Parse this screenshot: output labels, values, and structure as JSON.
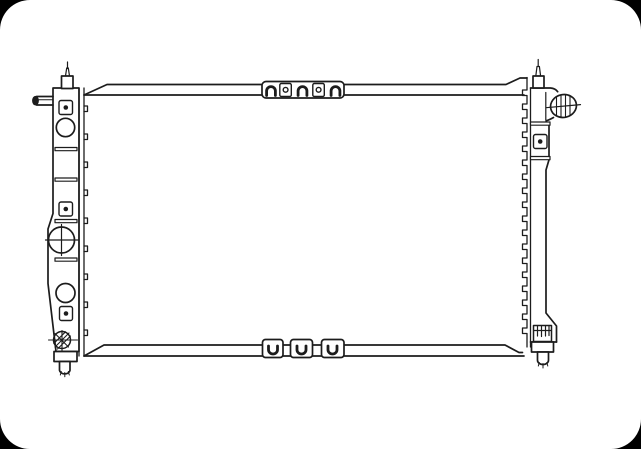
{
  "colors": {
    "line": "#1c1c1c",
    "paper": "#ffffff",
    "corner_mask": "#000000"
  },
  "drawing": {
    "subject": "radiator-technical-line-drawing",
    "visible_text": [],
    "parts": [
      {
        "name": "core-top-rail"
      },
      {
        "name": "core-bottom-rail"
      },
      {
        "name": "top-mount-bracket"
      },
      {
        "name": "bottom-mount-tabs"
      },
      {
        "name": "left-tank"
      },
      {
        "name": "filler-neck"
      },
      {
        "name": "left-inlet-pipe"
      },
      {
        "name": "mounting-hole-square"
      },
      {
        "name": "mounting-boss-circle"
      },
      {
        "name": "crosshair-boss"
      },
      {
        "name": "drain-plug"
      },
      {
        "name": "left-bottom-stub"
      },
      {
        "name": "right-tank"
      },
      {
        "name": "right-outlet-pipe"
      },
      {
        "name": "clip-grid"
      },
      {
        "name": "right-bottom-stub"
      },
      {
        "name": "crimp-tab-edge"
      },
      {
        "name": "corner-mask"
      }
    ]
  }
}
